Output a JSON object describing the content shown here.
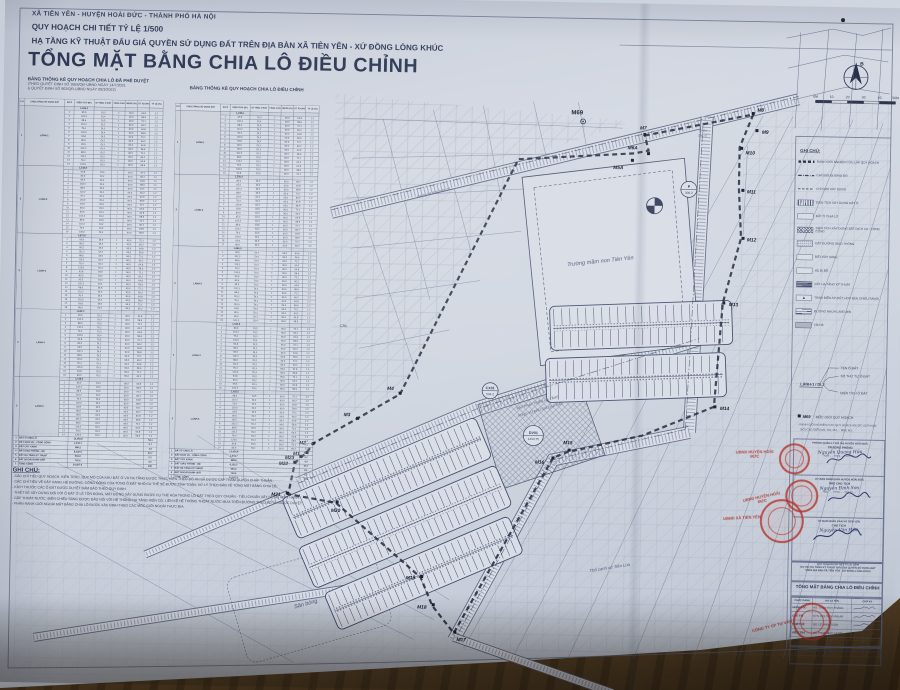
{
  "header": {
    "line1": "XÃ TIÊN YÊN - HUYỆN HOÀI ĐỨC - THÀNH PHỐ HÀ NỘI",
    "line2": "QUY HOẠCH CHI TIẾT TỶ LỆ 1/500",
    "line3": "HẠ TẦNG KỸ THUẬT ĐẤU GIÁ QUYỀN SỬ DỤNG ĐẤT TRÊN ĐỊA BÀN XÃ TIÊN YÊN - XỨ ĐỒNG LÒNG KHÚC",
    "title": "TỔNG MẶT BẰNG CHIA LÔ ĐIỀU CHỈNH",
    "table1_caption": "BẢNG THỐNG KÊ QUY HOẠCH CHIA LÔ ĐÃ PHÊ DUYỆT",
    "table1_sub1": "(THEO QUYẾT ĐỊNH SỐ 3855/QĐ-UBND NGÀY 14/7/2021",
    "table1_sub2": "& QUYẾT ĐỊNH SỐ 902/QĐ-UBND NGÀY 09/3/2022)",
    "table2_caption": "BẢNG THỐNG KÊ QUY HOẠCH CHIA LÔ ĐIỀU CHỈNH"
  },
  "tables": {
    "col_headers": [
      "STT",
      "CHỨC NĂNG SỬ DỤNG ĐẤT",
      "SỐ Ô",
      "DIỆN TÍCH (M²)",
      "KÝ HIỆU Ô ĐẤT",
      "TẦNG CAO",
      "MĐXD (%)",
      "DT XD (M²)",
      "TỶ LỆ (%)"
    ],
    "approved": {
      "groups": [
        {
          "stt": "1",
          "label": "LÀNH-1",
          "area": "1,236.4",
          "rows": 14
        },
        {
          "stt": "2",
          "label": "LÀNH-2",
          "area": "1,542.8",
          "rows": 16
        },
        {
          "stt": "3",
          "label": "LÀNH-3",
          "area": "1,873.6",
          "rows": 18
        },
        {
          "stt": "4",
          "label": "LÀNH-4",
          "area": "1,622.4",
          "rows": 16
        },
        {
          "stt": "5",
          "label": "LÀNH-5",
          "area": "1,418.2",
          "rows": 14
        }
      ]
    },
    "adjusted": {
      "groups": [
        {
          "stt": "1",
          "label": "LÀNH-1",
          "area": "1,248.6",
          "rows": 15
        },
        {
          "stt": "2",
          "label": "LÀNH-2",
          "area": "1,556.2",
          "rows": 17
        },
        {
          "stt": "3",
          "label": "LÀNH-3",
          "area": "1,884.0",
          "rows": 18
        },
        {
          "stt": "4",
          "label": "LÀNH-4",
          "area": "1,630.8",
          "rows": 16
        },
        {
          "stt": "5",
          "label": "LÀNH-5",
          "area": "1,422.5",
          "rows": 14
        }
      ]
    },
    "area_pool": [
      "80.0",
      "95.5",
      "102.3",
      "88.6",
      "110.2",
      "76.4",
      "120.0",
      "93.8"
    ],
    "xd_pool": [
      "60.2",
      "64.8",
      "58.9",
      "72.1"
    ],
    "kh_pool": [
      "DL2",
      "DL3",
      "DL4",
      "DL5"
    ],
    "tang": "1",
    "mdxd": "90.0",
    "hsd": "1.2",
    "summary_labels": [
      "ĐẤT Ở CHIA LÔ",
      "ĐẤT DỊCH VỤ - CÔNG CỘNG",
      "ĐẤT CÂY XANH",
      "ĐẤT GIAO THÔNG - HÈ",
      "ĐẤT HẠ TẦNG KỸ THUẬT",
      "ĐẤT NGOÀI RANH GIỚI",
      "TỔNG CỘNG"
    ],
    "summary_values": [
      "12,456.8",
      "1,344.7",
      "986.2",
      "8,132.5",
      "504.2",
      "742.6",
      "24,567.0"
    ],
    "summary_pct": [
      "53.1",
      "5.7",
      "4.2",
      "34.7",
      "2.1",
      "3.2",
      "100"
    ]
  },
  "notes": {
    "heading": "GHI CHÚ:",
    "lines": [
      "- CÁC CHỈ TIÊU QUY HOẠCH, KIẾN TRÚC, QUY MÔ CỦA KHU ĐẤT Ở VÀ HẠ TẦNG ĐƯỢC THỰC HIỆN THEO ĐỒ ÁN ĐÃ ĐƯỢC CẤP THẨM QUYỀN CHẤP THUẬN.",
      "- CÁC CHỈ TIÊU VỀ CÂY XANH, HÈ ĐƯỜNG, CÔNG CỘNG CỦA TỪNG Ô ĐẤT NHỎ CỤ THỂ SẼ ĐƯỢC TÍNH TOÁN, XỬ LÝ THEO BẢN VẼ TỔNG MẶT BẰNG CHIA LÔ.",
      "- KÍCH THƯỚC CÁC Ô ĐẤT ĐƯỢC DUYỆT ĐẢM BẢO THEO QUY ĐỊNH.",
      "- THIẾT KẾ XÂY DỰNG ĐỐI VỚI Ô ĐẤT Ở LẺ TỒN ĐỌNG, MẶT ĐỨNG XÂY DỰNG ĐƯỢC CỤ THỂ HÓA TRONG LÔ ĐẤT THEO QUY CHUẨN - TIÊU CHUẨN XÂY DỰNG HIỆN HÀNH.",
      "- CẤP THOÁT NƯỚC, ĐIỆN CHIẾU SÁNG ĐƯỢC ĐẤU NỐI VỚI HỆ THỐNG HẠ TẦNG HIỆN CÓ, LIỀN KỀ HỆ THỐNG THOÁT NƯỚC MƯA TRÊN ĐƯỜNG THEO ĐỒ ÁN ĐƯỢC DUYỆT.",
      "- PHẦN RANH GIỚI NGOÀI MẶT BẰNG CHIA LÔ ĐƯỢC XÁC ĐỊNH THEO CÁC MỐC GIỚI NGOÀI THỰC ĐỊA."
    ]
  },
  "legend": {
    "title": "GHI CHÚ:",
    "items": [
      {
        "type": "l-bound",
        "label": "RANH GIỚI NGHIÊN CỨU LẬP QUY HOẠCH"
      },
      {
        "type": "l-red",
        "label": "CHỈ GIỚI ĐƯỜNG ĐỎ"
      },
      {
        "type": "l-dash",
        "label": "CHỈ GIỚI XÂY DỰNG"
      },
      {
        "type": "l-hv",
        "label": "DIỆN TÍCH XÂY DỰNG ĐẤT Ở"
      },
      {
        "type": "l-pl",
        "label": "ĐẤT Ở CHIA LÔ"
      },
      {
        "type": "l-hx",
        "label": "DIỆN TÍCH XÂY DỰNG ĐẤT DỊCH VỤ - CÔNG CỘNG"
      },
      {
        "type": "l-dot",
        "label": "ĐẤT ĐƯỜNG GIAO THÔNG"
      },
      {
        "type": "l-pl",
        "label": "ĐẤT CÂY XANH"
      },
      {
        "type": "l-pl",
        "label": "HÈ ĐI BỘ"
      },
      {
        "type": "l-hd",
        "label": "ĐẤT HẠ TẦNG KỸ THUẬT"
      },
      {
        "type": "l-tba",
        "label": "TRẠM BIẾN ÁP (KẾT HỢP ĐÈN CHIẾU SÁNG)",
        "glyph": "▲"
      },
      {
        "type": "l-ln",
        "label": "ĐƯỜNG NHỰA LÁNG MỊN"
      },
      {
        "type": "l-gy",
        "label": "VỈA HÈ"
      }
    ]
  },
  "diagram": {
    "ten": "TÊN Ô ĐẤT",
    "so": "SỐ THỨ TỰ Ô ĐẤT",
    "sample": "LÁNH-1 / DL2",
    "dt": "DIỆN TÍCH Ô ĐẤT"
  },
  "moc": {
    "sym": "M69",
    "text": ": MỐC GIỚI QUY HOẠCH",
    "sub1": "- RANH GIỚI NGHIÊN CỨU QUY HOẠCH ĐƯỢC GIỚI HẠN",
    "sub2": "BỞI CÁC ĐIỂM M1, M2, M3 ... M69, M1."
  },
  "approvals": [
    {
      "header": "PHÒNG QUẢN LÝ ĐÔ THỊ HUYỆN HOÀI ĐỨC",
      "role": "TRƯỞNG PHÒNG",
      "name": "Nguyễn Quang Hữu",
      "date": "Ngày ..... tháng ..... năm 20....."
    },
    {
      "header": "ỦY BAN NHÂN DÂN HUYỆN HOÀI ĐỨC",
      "role": "PHÓ CHỦ TỊCH",
      "name": "Nguyễn Đình Sơn",
      "date": "Ngày ..... tháng ..... năm 20....."
    },
    {
      "header": "ỦY BAN NHÂN DÂN XÃ TIÊN YÊN",
      "role": "CHỦ TỊCH",
      "name": "Nguyễn Văn Hậu",
      "date": ""
    }
  ],
  "project_lines": [
    "QUY HOẠCH CHI TIẾT TỶ LỆ 1/500",
    "DỰ ÁN: HẠ TẦNG KỸ THUẬT ĐẤU GIÁ QUYỀN SỬ DỤNG ĐẤT",
    "TRÊN ĐỊA BÀN XÃ TIÊN YÊN - XỨ ĐỒNG LÒNG KHÚC"
  ],
  "sheet_title": "TỔNG MẶT BẰNG CHIA LÔ ĐIỀU CHỈNH",
  "sig_table": {
    "headers": [
      "CHỨC DANH",
      "HỌ VÀ TÊN",
      "CHỮ KÝ"
    ],
    "rows": [
      {
        "role": "GIÁM ĐỐC",
        "name": "KS. TRẦN HUY THẮNG"
      },
      {
        "role": "CHỦ TRÌ",
        "name": "KTS. NGUYỄN VĂN AN"
      },
      {
        "role": "THIẾT KẾ",
        "name": "KS. LÊ MINH TUẤN"
      },
      {
        "role": "KIỂM TRA",
        "name": "KS. PHẠM ĐỨC HÙNG"
      }
    ]
  },
  "footer_company": "CÔNG TY CỔ PHẦN TƯ VẤN ĐẦU TƯ XÂY DỰNG VÀ THƯƠNG MẠI HÀ NỘI",
  "scale_labels": [
    "0M",
    "10",
    "20",
    "30",
    "40",
    "50M"
  ],
  "compass_letter": "B",
  "map": {
    "markers": [
      {
        "n": "M1",
        "x": 310,
        "y": 455,
        "dx": -14,
        "dy": 3
      },
      {
        "n": "M2",
        "x": 316,
        "y": 446,
        "dx": -14,
        "dy": 1
      },
      {
        "n": "M3",
        "x": 360,
        "y": 420,
        "dx": -14,
        "dy": -2
      },
      {
        "n": "M4",
        "x": 402,
        "y": 394,
        "dx": -13,
        "dy": -3
      },
      {
        "n": "M5A",
        "x": 630,
        "y": 157,
        "dx": -19,
        "dy": 9
      },
      {
        "n": "M6A",
        "x": 646,
        "y": 150,
        "dx": -21,
        "dy": -4
      },
      {
        "n": "M7",
        "x": 642,
        "y": 131,
        "dx": -5,
        "dy": -5
      },
      {
        "n": "M8",
        "x": 750,
        "y": 108,
        "dx": 4,
        "dy": -2
      },
      {
        "n": "M9",
        "x": 754,
        "y": 125,
        "dx": 5,
        "dy": 3
      },
      {
        "n": "M10",
        "x": 739,
        "y": 143,
        "dx": 4,
        "dy": 6
      },
      {
        "n": "M11",
        "x": 741,
        "y": 185,
        "dx": 4,
        "dy": 3
      },
      {
        "n": "M12",
        "x": 742,
        "y": 233,
        "dx": 4,
        "dy": 3
      },
      {
        "n": "M13",
        "x": 724,
        "y": 298,
        "dx": 5,
        "dy": 3
      },
      {
        "n": "M14",
        "x": 717,
        "y": 402,
        "dx": 5,
        "dy": 3
      },
      {
        "n": "M15",
        "x": 572,
        "y": 448,
        "dx": -6,
        "dy": -6
      },
      {
        "n": "M16",
        "x": 556,
        "y": 456,
        "dx": -18,
        "dy": 6
      },
      {
        "n": "M17",
        "x": 461,
        "y": 632,
        "dx": 2,
        "dy": 9
      },
      {
        "n": "M18",
        "x": 439,
        "y": 605,
        "dx": -16,
        "dy": 4
      },
      {
        "n": "M19",
        "x": 427,
        "y": 577,
        "dx": -16,
        "dy": 3
      },
      {
        "n": "M20",
        "x": 341,
        "y": 504,
        "dx": -6,
        "dy": 10
      },
      {
        "n": "M21",
        "x": 291,
        "y": 496,
        "dx": -16,
        "dy": 3
      },
      {
        "n": "M22",
        "x": 298,
        "y": 465,
        "dx": -16,
        "dy": 3
      },
      {
        "n": "M23",
        "x": 304,
        "y": 459,
        "dx": -16,
        "dy": 3
      }
    ],
    "labels": [
      {
        "t": "Trường mầm non Tiên Yên",
        "x": 600,
        "y": 260,
        "r": -7,
        "s": 5.6,
        "i": 1
      },
      {
        "t": "Sân bóng",
        "x": 312,
        "y": 608,
        "r": -16,
        "s": 5.6,
        "i": 1
      },
      {
        "t": "M69",
        "x": 574,
        "y": 112,
        "r": 0,
        "s": 6,
        "b": 1
      },
      {
        "t": "ĐẤT PHÁT TRIỂN HẠ TẦNG",
        "x": 540,
        "y": 402,
        "r": -17,
        "s": 3.4
      },
      {
        "t": "PHỤC VỤ ĐẤU GIÁ QSD ĐẤT",
        "x": 543,
        "y": 409,
        "r": -17,
        "s": 3.4
      },
      {
        "t": "Thổ canh xứ Tiên Lùa",
        "x": 615,
        "y": 566,
        "r": -10,
        "s": 4.2,
        "i": 1
      },
      {
        "t": "Cầu",
        "x": 344,
        "y": 329,
        "r": 0,
        "s": 4,
        "i": 1
      },
      {
        "t": "đường bê tông hiện có",
        "x": 432,
        "y": 194,
        "r": -15,
        "s": 3.4,
        "i": 1
      },
      {
        "t": "CH04",
        "x": 700,
        "y": 127,
        "r": 0,
        "s": 3
      },
      {
        "t": "230.47",
        "x": 700,
        "y": 132,
        "r": 0,
        "s": 3
      }
    ],
    "circles": [
      {
        "t": "P",
        "s": "306.2",
        "x": 687,
        "y": 185,
        "r": 8
      },
      {
        "t": "DV01",
        "s": "1344.75",
        "x": 536,
        "y": 434,
        "r": 10
      },
      {
        "t": "CX01",
        "s": "504.2",
        "x": 492,
        "y": 390,
        "r": 8
      }
    ]
  }
}
